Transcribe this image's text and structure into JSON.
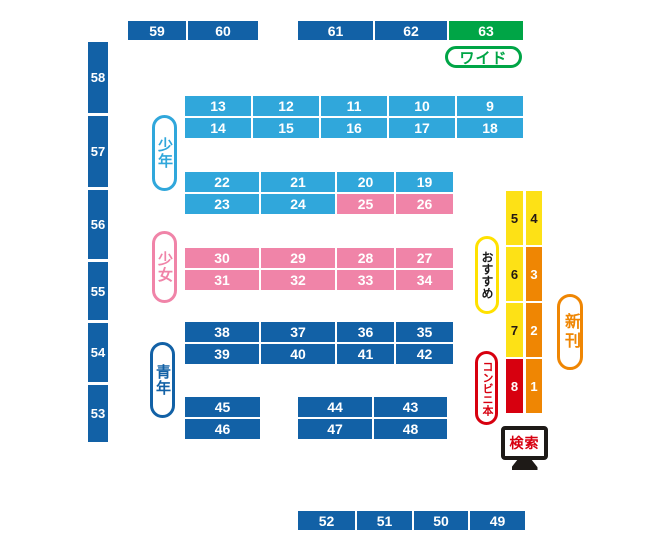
{
  "colors": {
    "dark_blue": "#1261a6",
    "light_blue": "#30a7db",
    "pink": "#f084a8",
    "green": "#00a546",
    "yellow": "#fde116",
    "orange": "#ef8603",
    "red": "#d7000f"
  },
  "wall": {
    "left": [
      "58",
      "57",
      "56",
      "55",
      "54",
      "53"
    ],
    "top_left_group": [
      "59",
      "60"
    ],
    "top_right_group": [
      "61",
      "62"
    ],
    "top_green": "63",
    "bottom": [
      "52",
      "51",
      "50",
      "49"
    ]
  },
  "legend": {
    "wide": "ワイド",
    "boys": "少年",
    "girls": "少女",
    "seinen": "青年",
    "recommended": "おすすめ",
    "new_releases": "新刊",
    "convenience_books": "コンビニ本",
    "search": "検索"
  },
  "shelves": {
    "boys_upper": {
      "row1": [
        "13",
        "12",
        "11",
        "10",
        "9"
      ],
      "row2": [
        "14",
        "15",
        "16",
        "17",
        "18"
      ]
    },
    "boys_lower": {
      "row1": [
        "22",
        "21",
        "20",
        "19"
      ],
      "row2": [
        "23",
        "24",
        "25",
        "26"
      ]
    },
    "girls": {
      "row1": [
        "30",
        "29",
        "28",
        "27"
      ],
      "row2": [
        "31",
        "32",
        "33",
        "34"
      ]
    },
    "seinen_upper": {
      "row1": [
        "38",
        "37",
        "36",
        "35"
      ],
      "row2": [
        "39",
        "40",
        "41",
        "42"
      ]
    },
    "seinen_lower": {
      "left_col": [
        "45",
        "46"
      ],
      "right_row1": [
        "44",
        "43"
      ],
      "right_row2": [
        "47",
        "48"
      ]
    },
    "featured": {
      "col1": [
        "5",
        "6",
        "7",
        "8"
      ],
      "col2": [
        "4",
        "3",
        "2",
        "1"
      ]
    }
  }
}
